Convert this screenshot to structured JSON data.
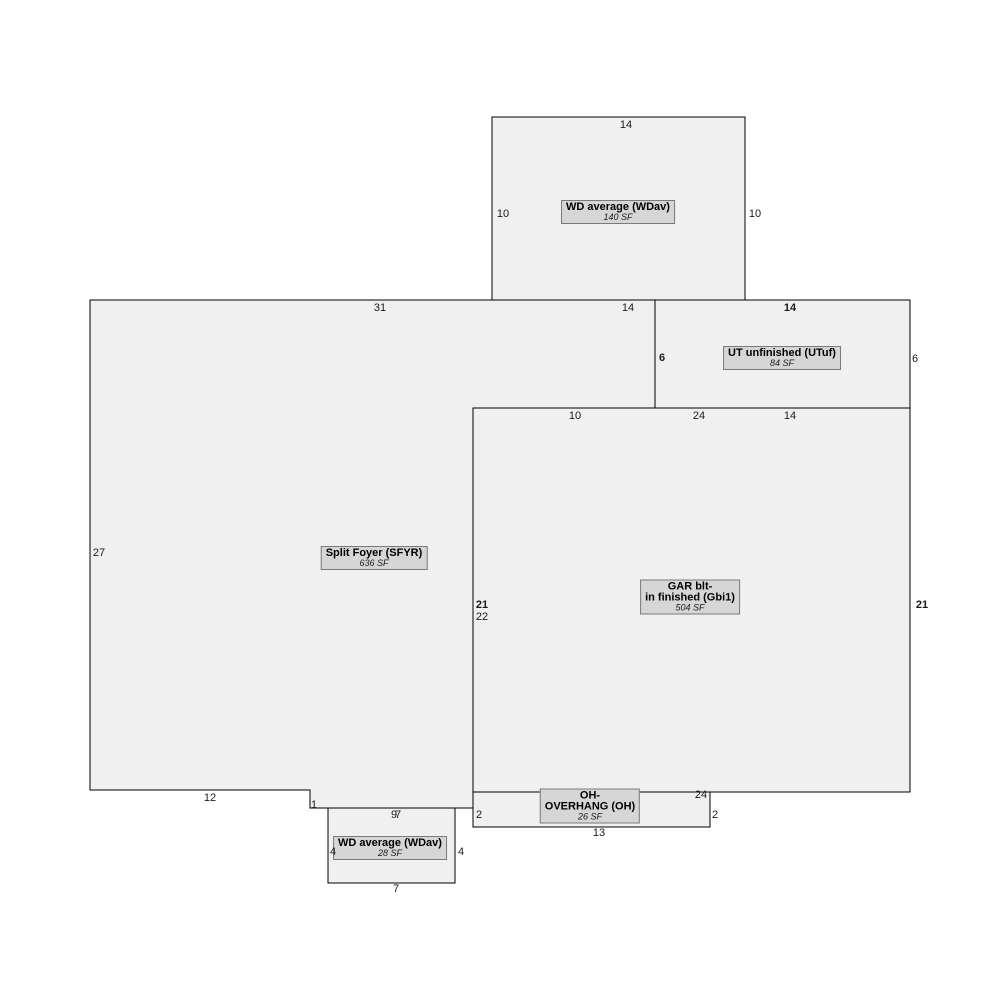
{
  "sketch": {
    "regions": {
      "wd_top": {
        "name": "WD average (WDav)",
        "area": "140 SF"
      },
      "ut": {
        "name": "UT unfinished (UTuf)",
        "area": "84 SF"
      },
      "sfyr": {
        "name": "Split Foyer (SFYR)",
        "area": "636 SF"
      },
      "gar": {
        "name_line1": "GAR blt-",
        "name_line2": "in finished (Gbi1)",
        "area": "504 SF"
      },
      "oh": {
        "name_line1": "OH-",
        "name_line2": "OVERHANG (OH)",
        "area": "26 SF"
      },
      "wd_bottom": {
        "name": "WD average (WDav)",
        "area": "28 SF"
      }
    },
    "dims": {
      "wd_top_top": "14",
      "wd_top_left": "10",
      "wd_top_right": "10",
      "wd_top_bottom": "14",
      "sfyr_top": "31",
      "sfyr_left": "27",
      "sfyr_right": "22",
      "sfyr_bottom_left": "12",
      "sfyr_notch": "1",
      "sfyr_bottom_right": "9",
      "ut_top": "14",
      "ut_left": "6",
      "ut_right": "6",
      "gar_top_left": "10",
      "gar_top_total": "24",
      "gar_top_right": "14",
      "gar_left": "21",
      "gar_right": "21",
      "gar_bottom": "24",
      "oh_left": "2",
      "oh_right": "2",
      "oh_bottom": "13",
      "wd_bottom_top": "7",
      "wd_bottom_left": "4",
      "wd_bottom_right": "4",
      "wd_bottom_bottom": "7"
    },
    "colors": {
      "background": "#ffffff",
      "region_fill": "#f0f0f0",
      "label_fill": "#d6d6d6",
      "label_border": "#7a7a7a",
      "line": "#000000"
    }
  }
}
